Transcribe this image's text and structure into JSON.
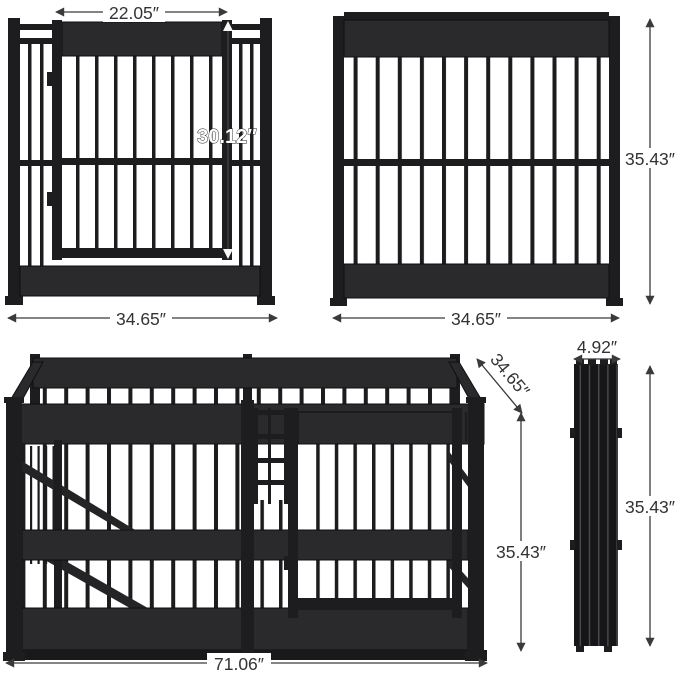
{
  "title": "Dog crate panel dimension diagram",
  "colors": {
    "frame": "#1d1d1f",
    "panel_band": "#2a2a2d",
    "dimension_line": "#3a3a3a",
    "dimension_text": "#333333",
    "door_height_label_fill": "#ffffff",
    "background": "#ffffff"
  },
  "views": {
    "front_panel": {
      "door_width": "22.05″",
      "door_height": "30.12″",
      "panel_width": "34.65″"
    },
    "side_panel": {
      "height": "35.43″",
      "width": "34.65″"
    },
    "assembled": {
      "length": "71.06″",
      "depth": "34.65″",
      "height": "35.43″"
    },
    "folded": {
      "thickness": "4.92″",
      "height": "35.43″"
    }
  }
}
